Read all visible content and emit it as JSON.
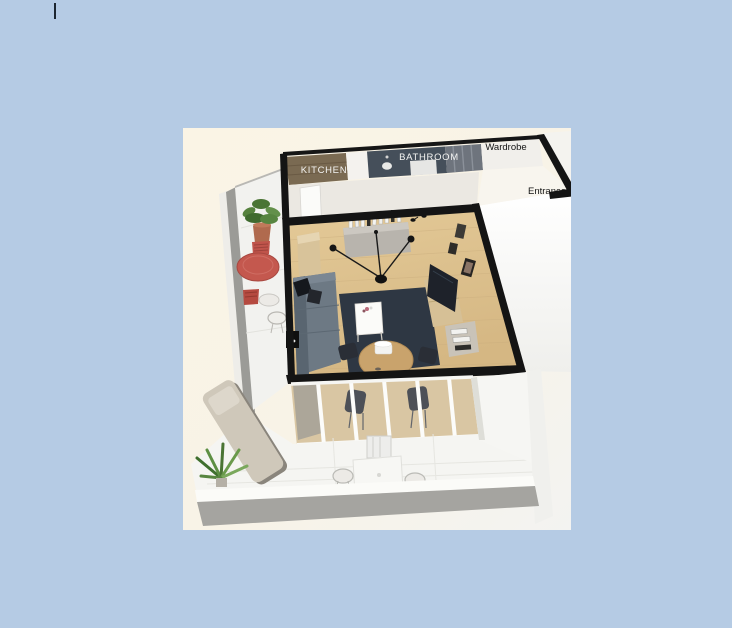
{
  "page": {
    "background_color": "#b5cbe4",
    "text_cursor": {
      "color": "#1c2630"
    }
  },
  "floorplan_image": {
    "description_labels": {
      "kitchen": "KITCHEN",
      "bathroom": "BATHROOM",
      "wardrobe": "Wardrobe",
      "entrance": "Entrance"
    },
    "palette": {
      "image_background": "#faf4e6",
      "walls": "#141414",
      "wood_floor": "#ddc08f",
      "rug": "#2e3743",
      "sofa": "#6d7984",
      "kitchen_wood": "#7a6a52",
      "bathroom_dark": "#454f5a",
      "red_table": "#c4584e",
      "terrace_fascia": "#a5a4a0",
      "plant_green": "#4a7434"
    }
  }
}
